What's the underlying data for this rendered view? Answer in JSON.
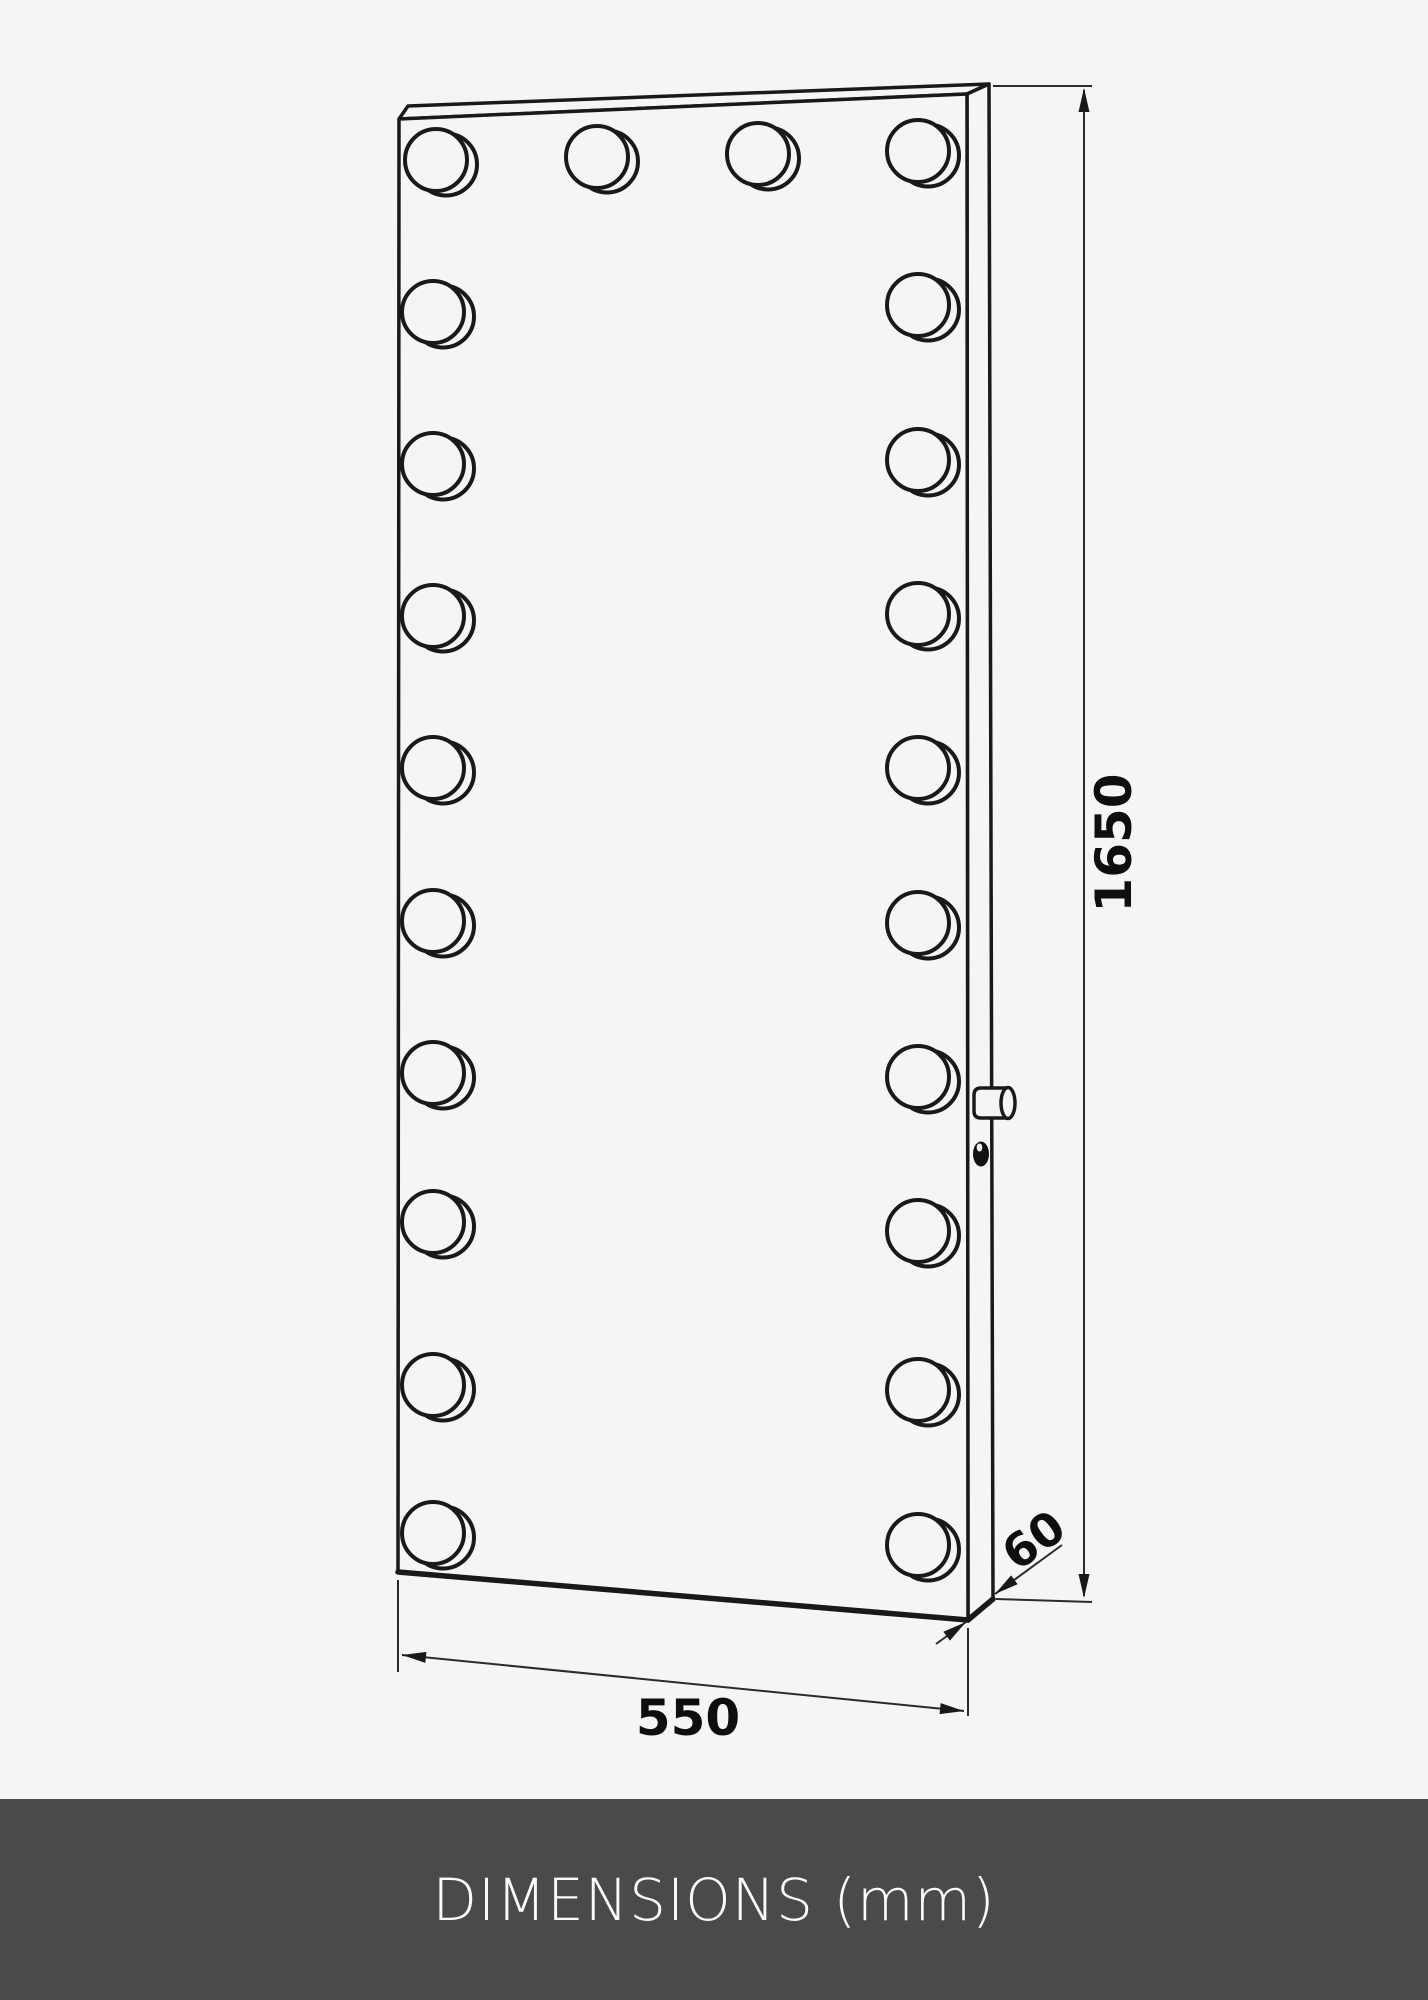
{
  "page": {
    "background_color": "#f4f5f7",
    "line_color": "#19191b",
    "thin_line_color": "#2b2b2d"
  },
  "footer": {
    "label": "DIMENSIONS (mm)",
    "background_color": "#4a4a4a",
    "text_color": "#fbfbfb"
  },
  "dimensions": {
    "unit": "mm",
    "width": {
      "value": "550"
    },
    "height": {
      "value": "1650"
    },
    "depth": {
      "value": "60"
    }
  },
  "mirror": {
    "type": "hollywood-mirror-line-drawing",
    "bulbs_top_row": 4,
    "bulbs_left_column": 10,
    "bulbs_right_column": 10,
    "bulbs_total": 22,
    "has_power_knob": true,
    "has_sensor_dot": true
  }
}
